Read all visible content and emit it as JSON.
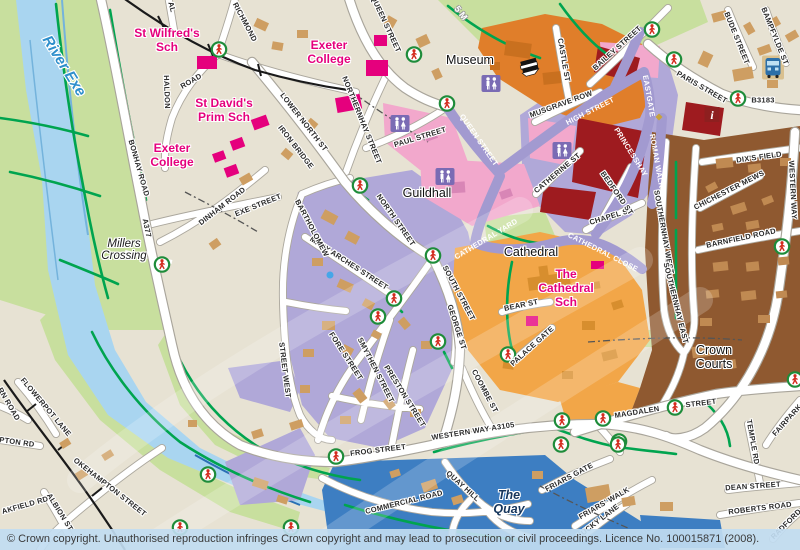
{
  "map": {
    "attribution": "© Crown copyright. Unauthorised reproduction infringes Crown copyright and may lead to prosecution or civil proceedings. Licence No. 100015871 (2008).",
    "colors": {
      "background": "#E7E2D3",
      "park": "#C8DF9E",
      "river": "#A9D5F0",
      "pedestrian_zone": "#B0A8D8",
      "pedestrian_street": "#A29AD0",
      "museum_district": "#E07E2A",
      "cathedral_precinct": "#F2A648",
      "southernhay_district": "#8F5930",
      "shopping_blocks": "#9E1B1F",
      "public_building": "#E5007D",
      "building": "#CE9E62",
      "quay_district": "#3D7EC2",
      "route_green": "#00A44F",
      "road": "#FFFFFF"
    },
    "street_labels": [
      {
        "t": "QUEEN STREET",
        "x": 386,
        "y": 24,
        "r": 65
      },
      {
        "t": "RICHMOND",
        "x": 245,
        "y": 22,
        "r": 62
      },
      {
        "t": "AL",
        "x": 172,
        "y": 7,
        "r": 75
      },
      {
        "t": "HALDON",
        "x": 167,
        "y": 92,
        "r": 88
      },
      {
        "t": "ROAD",
        "x": 191,
        "y": 81,
        "r": -30
      },
      {
        "t": "BONHAY ROAD",
        "x": 139,
        "y": 168,
        "r": 74
      },
      {
        "t": "A377",
        "x": 147,
        "y": 228,
        "r": 78
      },
      {
        "t": "DINHAM ROAD",
        "x": 222,
        "y": 206,
        "r": -38
      },
      {
        "t": "EXE STREET",
        "x": 258,
        "y": 205,
        "r": -22
      },
      {
        "t": "LOWER NORTH ST",
        "x": 304,
        "y": 122,
        "r": 52
      },
      {
        "t": "IRON BRIDGE",
        "x": 296,
        "y": 147,
        "r": 52
      },
      {
        "t": "NORTHERNHAY STREET",
        "x": 362,
        "y": 120,
        "r": 68
      },
      {
        "t": "PAUL STREET",
        "x": 420,
        "y": 137,
        "r": -17
      },
      {
        "t": "QUEEN STREET",
        "x": 479,
        "y": 140,
        "r": 55,
        "s": "w"
      },
      {
        "t": "CASTLE ST",
        "x": 564,
        "y": 60,
        "r": 80
      },
      {
        "t": "BAILEY STREET",
        "x": 617,
        "y": 48,
        "r": -42
      },
      {
        "t": "MUSGRAVE ROW",
        "x": 561,
        "y": 104,
        "r": -20
      },
      {
        "t": "HIGH STREET",
        "x": 590,
        "y": 111,
        "r": -27,
        "s": "w"
      },
      {
        "t": "EASTGATE",
        "x": 649,
        "y": 96,
        "r": 80,
        "s": "w"
      },
      {
        "t": "PRINCESSHAY",
        "x": 631,
        "y": 152,
        "r": 58,
        "s": "w"
      },
      {
        "t": "ROMAN WALK",
        "x": 657,
        "y": 161,
        "r": 80,
        "s": "w"
      },
      {
        "t": "PARIS STREET",
        "x": 702,
        "y": 87,
        "r": 30
      },
      {
        "t": "B3183",
        "x": 763,
        "y": 100,
        "r": 0
      },
      {
        "t": "BUDE STREET",
        "x": 737,
        "y": 38,
        "r": 68
      },
      {
        "t": "BAMPFYLDE ST",
        "x": 775,
        "y": 36,
        "r": 68
      },
      {
        "t": "DIX'S FIELD",
        "x": 759,
        "y": 157,
        "r": -8
      },
      {
        "t": "CHICHESTER MEWS",
        "x": 729,
        "y": 190,
        "r": -27
      },
      {
        "t": "BARNFIELD ROAD",
        "x": 741,
        "y": 238,
        "r": -12
      },
      {
        "t": "SOUTHERNHAY WEST",
        "x": 664,
        "y": 232,
        "r": 80
      },
      {
        "t": "SOUTHERNHAY EAST",
        "x": 676,
        "y": 303,
        "r": 76
      },
      {
        "t": "CHAPEL ST",
        "x": 611,
        "y": 216,
        "r": -17
      },
      {
        "t": "BEDFORD ST",
        "x": 617,
        "y": 193,
        "r": 55
      },
      {
        "t": "CATHERINE ST",
        "x": 557,
        "y": 173,
        "r": -40
      },
      {
        "t": "CATHEDRAL YARD",
        "x": 486,
        "y": 239,
        "r": -31,
        "s": "w"
      },
      {
        "t": "CATHEDRAL CLOSE",
        "x": 603,
        "y": 252,
        "r": 27,
        "s": "w"
      },
      {
        "t": "NORTH STREET",
        "x": 396,
        "y": 220,
        "r": 55
      },
      {
        "t": "SOUTH STREET",
        "x": 459,
        "y": 293,
        "r": 62
      },
      {
        "t": "MARY ARCHES STREET",
        "x": 349,
        "y": 263,
        "r": 33
      },
      {
        "t": "BARTHOLOMEW",
        "x": 312,
        "y": 228,
        "r": 62
      },
      {
        "t": "STREET WEST",
        "x": 285,
        "y": 370,
        "r": 83
      },
      {
        "t": "FORE STREET",
        "x": 346,
        "y": 356,
        "r": 57
      },
      {
        "t": "SMYTHEN STREET",
        "x": 376,
        "y": 370,
        "r": 63
      },
      {
        "t": "PRESTON STREET",
        "x": 405,
        "y": 396,
        "r": 58
      },
      {
        "t": "GEORGE ST",
        "x": 457,
        "y": 327,
        "r": 72
      },
      {
        "t": "BEAR ST",
        "x": 521,
        "y": 305,
        "r": -12
      },
      {
        "t": "PALACE GATE",
        "x": 532,
        "y": 346,
        "r": -42
      },
      {
        "t": "MAGDALEN",
        "x": 637,
        "y": 412,
        "r": -9
      },
      {
        "t": "STREET",
        "x": 701,
        "y": 403,
        "r": -7
      },
      {
        "t": "WESTERN WAY A3105",
        "x": 473,
        "y": 431,
        "r": -9
      },
      {
        "t": "FROG STREET",
        "x": 378,
        "y": 450,
        "r": -7
      },
      {
        "t": "COMMERCIAL ROAD",
        "x": 404,
        "y": 502,
        "r": -14
      },
      {
        "t": "QUAY HILL",
        "x": 463,
        "y": 486,
        "r": 42
      },
      {
        "t": "COOMBE ST",
        "x": 485,
        "y": 391,
        "r": 62
      },
      {
        "t": "FRIARS GATE",
        "x": 569,
        "y": 477,
        "r": -28
      },
      {
        "t": "FRIARS' WALK",
        "x": 604,
        "y": 503,
        "r": -30
      },
      {
        "t": "LUCKY LANE",
        "x": 598,
        "y": 521,
        "r": -38
      },
      {
        "t": "TEMPLE RD",
        "x": 753,
        "y": 442,
        "r": 80
      },
      {
        "t": "DEAN STREET",
        "x": 753,
        "y": 486,
        "r": -4
      },
      {
        "t": "ROBERTS ROAD",
        "x": 760,
        "y": 508,
        "r": -7
      },
      {
        "t": "FAIRPARK",
        "x": 787,
        "y": 420,
        "r": -48
      },
      {
        "t": "RADFORD",
        "x": 786,
        "y": 524,
        "r": -45
      },
      {
        "t": "WESTERN WAY",
        "x": 793,
        "y": 190,
        "r": 87
      },
      {
        "t": "FLOWERPOT LANE",
        "x": 46,
        "y": 407,
        "r": 50
      },
      {
        "t": "OKEHAMPTON STREET",
        "x": 110,
        "y": 487,
        "r": 38
      },
      {
        "t": "RN ROAD",
        "x": 9,
        "y": 404,
        "r": 60
      },
      {
        "t": "PTON RD",
        "x": 17,
        "y": 442,
        "r": 8
      },
      {
        "t": "AKFIELD RD",
        "x": 25,
        "y": 505,
        "r": -16
      },
      {
        "t": "ALBION ST",
        "x": 60,
        "y": 512,
        "r": 58
      }
    ],
    "place_labels": [
      {
        "lines": [
          "River Exe"
        ],
        "x": 64,
        "y": 66,
        "cls": "water",
        "r": 58
      },
      {
        "lines": [
          "Millers",
          "Crossing"
        ],
        "x": 124,
        "y": 250,
        "cls": "minor-place"
      },
      {
        "lines": [
          "The",
          "Quay"
        ],
        "x": 509,
        "y": 502,
        "cls": "water-dark"
      },
      {
        "lines": [
          "Museum"
        ],
        "x": 470,
        "y": 60,
        "cls": "poi"
      },
      {
        "lines": [
          "Guildhall"
        ],
        "x": 427,
        "y": 193,
        "cls": "poi"
      },
      {
        "lines": [
          "Cathedral"
        ],
        "x": 531,
        "y": 252,
        "cls": "poi"
      },
      {
        "lines": [
          "Crown",
          "Courts"
        ],
        "x": 714,
        "y": 357,
        "cls": "poi"
      },
      {
        "lines": [
          "St Wilfred's",
          "Sch"
        ],
        "x": 167,
        "y": 40,
        "cls": "school"
      },
      {
        "lines": [
          "Exeter",
          "College"
        ],
        "x": 329,
        "y": 52,
        "cls": "school"
      },
      {
        "lines": [
          "Exeter",
          "College"
        ],
        "x": 172,
        "y": 155,
        "cls": "school"
      },
      {
        "lines": [
          "St David's",
          "Prim Sch"
        ],
        "x": 224,
        "y": 110,
        "cls": "school"
      },
      {
        "lines": [
          "The",
          "Cathedral",
          "Sch"
        ],
        "x": 566,
        "y": 288,
        "cls": "school"
      },
      {
        "lines": [
          "5 M"
        ],
        "x": 461,
        "y": 13,
        "cls": "road-white",
        "r": 52
      }
    ],
    "icons": {
      "crossing": {
        "name": "pedestrian-crossing-icon",
        "points": [
          [
            219,
            52
          ],
          [
            414,
            57
          ],
          [
            447,
            106
          ],
          [
            652,
            32
          ],
          [
            674,
            62
          ],
          [
            738,
            101
          ],
          [
            162,
            267
          ],
          [
            360,
            188
          ],
          [
            433,
            258
          ],
          [
            394,
            301
          ],
          [
            378,
            319
          ],
          [
            438,
            344
          ],
          [
            508,
            357
          ],
          [
            603,
            421
          ],
          [
            675,
            410
          ],
          [
            619,
            444
          ],
          [
            562,
            423
          ],
          [
            561,
            447
          ],
          [
            618,
            447
          ],
          [
            795,
            382
          ],
          [
            782,
            249
          ],
          [
            336,
            459
          ],
          [
            208,
            477
          ],
          [
            180,
            530
          ],
          [
            291,
            530
          ]
        ]
      },
      "toilets": {
        "name": "toilets-icon",
        "points": [
          [
            491,
            86
          ],
          [
            400,
            126
          ],
          [
            445,
            179
          ],
          [
            562,
            153
          ]
        ]
      },
      "bus": {
        "name": "bus-station-icon",
        "points": [
          [
            773,
            70
          ]
        ]
      },
      "info": {
        "name": "tourist-info-icon",
        "points": [
          [
            712,
            117
          ]
        ]
      },
      "museum": {
        "name": "museum-icon",
        "points": [
          [
            530,
            70
          ]
        ]
      },
      "dot_gold": {
        "name": "poi-dot-gold",
        "points": [
          [
            659,
            117
          ]
        ]
      },
      "dot_blue": {
        "name": "poi-dot-blue",
        "points": [
          [
            330,
            275
          ]
        ]
      }
    }
  }
}
